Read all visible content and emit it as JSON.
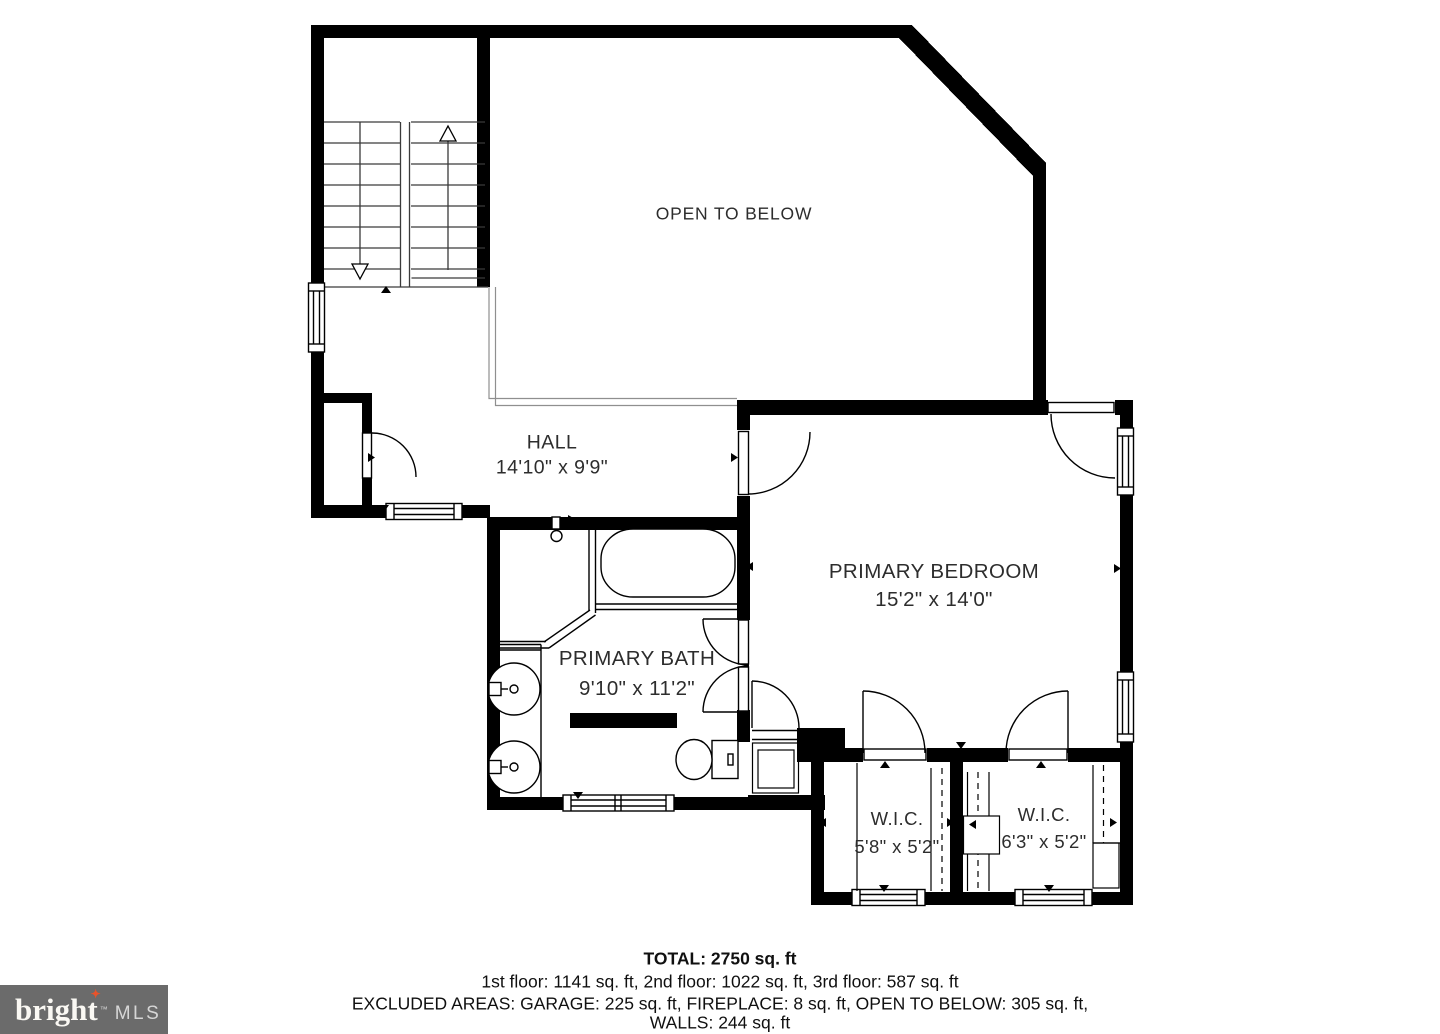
{
  "rooms": {
    "open_to_below": {
      "name": "OPEN TO BELOW"
    },
    "hall": {
      "name": "HALL",
      "dims": "14'10\" x 9'9\""
    },
    "primary_bedroom": {
      "name": "PRIMARY BEDROOM",
      "dims": "15'2\" x 14'0\""
    },
    "primary_bath": {
      "name": "PRIMARY BATH",
      "dims": "9'10\" x 11'2\""
    },
    "wic_left": {
      "name": "W.I.C.",
      "dims": "5'8\" x 5'2\""
    },
    "wic_right": {
      "name": "W.I.C.",
      "dims": "6'3\" x 5'2\""
    }
  },
  "summary": {
    "total": "TOTAL: 2750 sq. ft",
    "floors": "1st floor: 1141 sq. ft, 2nd floor: 1022 sq. ft, 3rd floor: 587 sq. ft",
    "excluded": "EXCLUDED AREAS: GARAGE: 225 sq. ft, FIREPLACE: 8 sq. ft, OPEN TO BELOW: 305 sq. ft,",
    "walls": "WALLS: 244 sq. ft"
  },
  "logo": {
    "brand": "bright",
    "tm": "™",
    "star": "✦",
    "suffix": "MLS",
    "bg_color": "#6b6b6b",
    "star_color": "#e8532a"
  }
}
